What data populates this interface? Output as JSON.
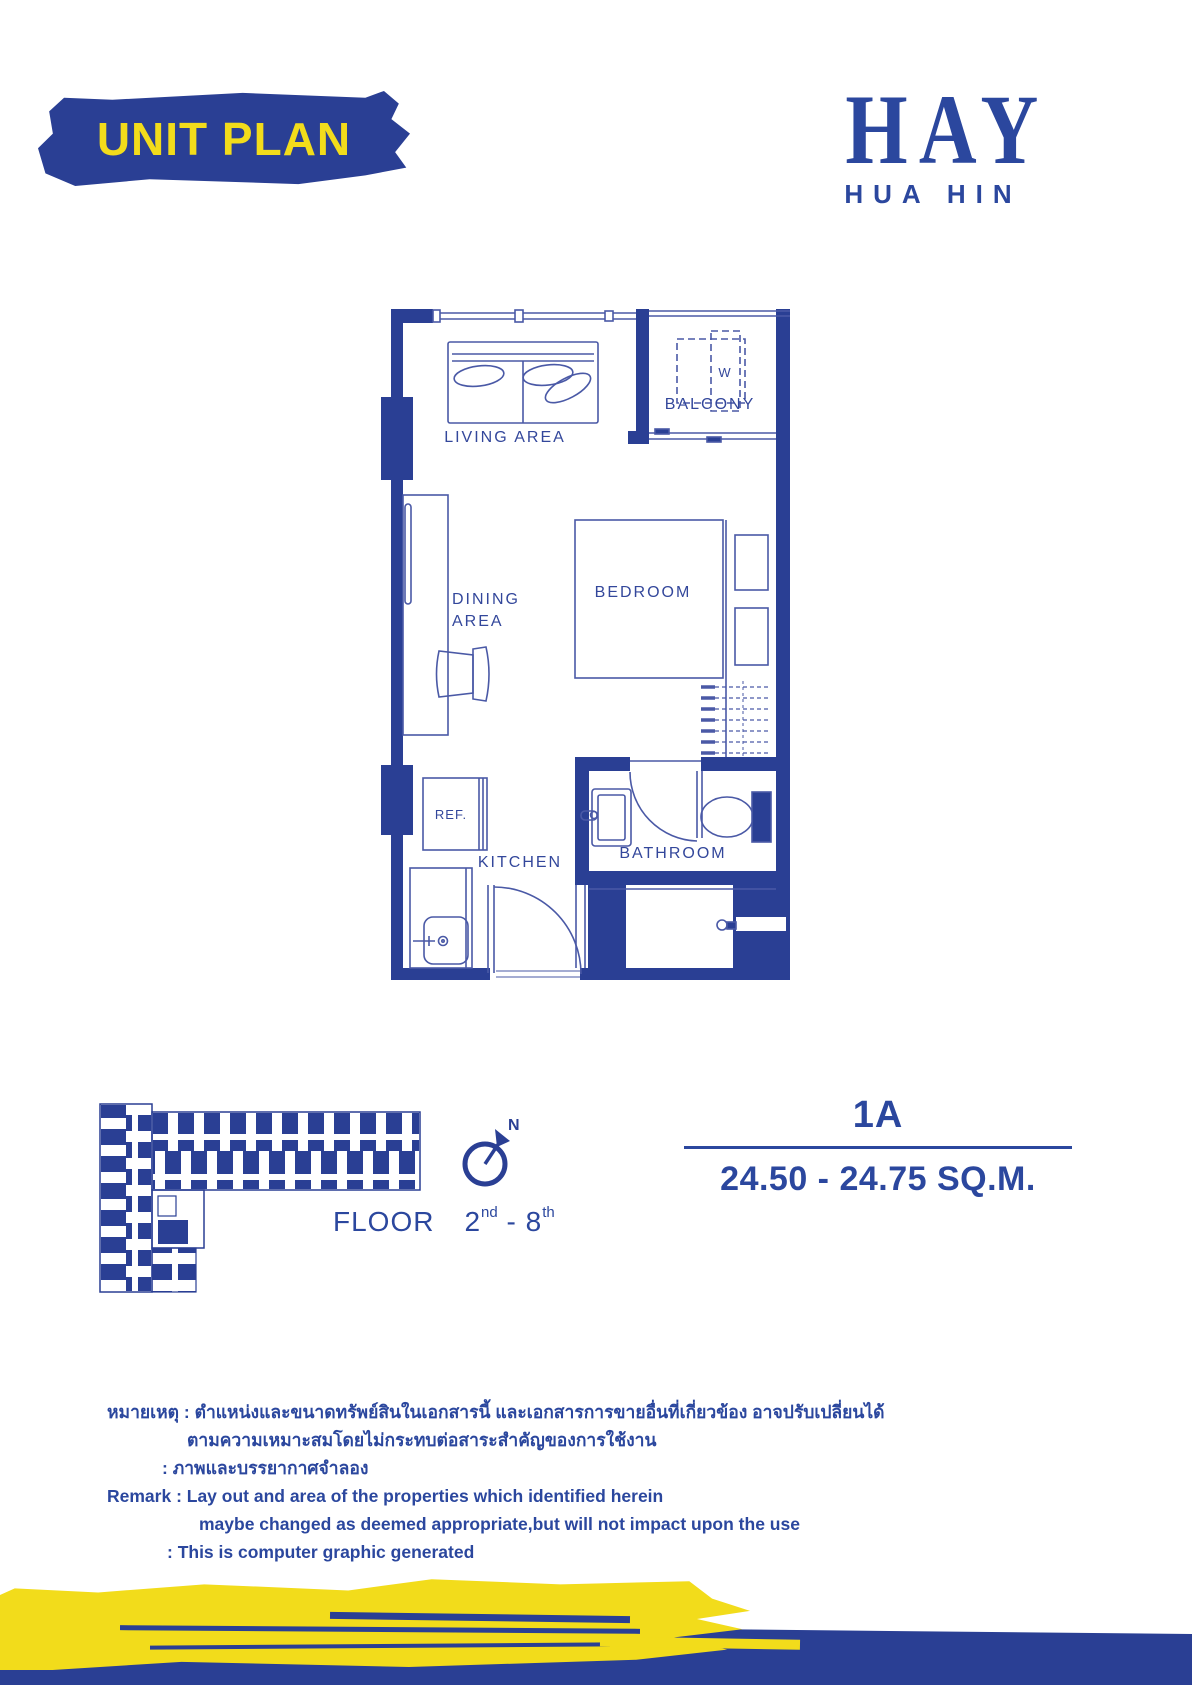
{
  "banner": {
    "title": "UNIT PLAN"
  },
  "logo": {
    "brand": "HAY",
    "location": "HUA HIN"
  },
  "plan": {
    "labels": {
      "living_area": "LIVING AREA",
      "balcony": "BALCONY",
      "washer": "W",
      "dining_line1": "DINING",
      "dining_line2": "AREA",
      "bedroom": "BEDROOM",
      "fridge": "REF.",
      "kitchen": "KITCHEN",
      "bathroom": "BATHROOM"
    }
  },
  "key_plan": {
    "compass_label": "N",
    "floor": {
      "label": "FLOOR",
      "from": "2",
      "from_suffix": "nd",
      "separator": "-",
      "to": "8",
      "to_suffix": "th"
    }
  },
  "unit_info": {
    "code": "1A",
    "area": "24.50 - 24.75 SQ.M."
  },
  "remarks": {
    "lines": [
      "หมายเหตุ : ตำแหน่งและขนาดทรัพย์สินในเอกสารนี้ และเอกสารการขายอื่นที่เกี่ยวข้อง อาจปรับเปลี่ยนได้",
      "ตามความเหมาะสมโดยไม่กระทบต่อสาระสำคัญของการใช้งาน",
      ": ภาพและบรรยากาศจำลอง",
      "Remark : Lay out and area of the properties which identified herein",
      "maybe changed as deemed appropriate,but will not impact upon the use",
      ": This is computer graphic generated"
    ]
  },
  "colors": {
    "primary_blue": "#2A3F94",
    "text_blue": "#2B479E",
    "plan_line_blue": "#4A59A6",
    "accent_yellow": "#F2DC1B"
  }
}
